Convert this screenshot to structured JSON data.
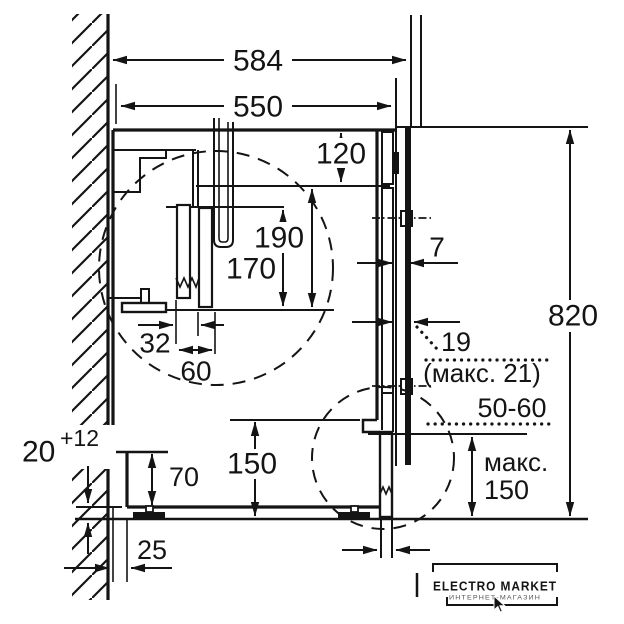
{
  "drawing": {
    "title": "built-in-washing-machine-installation-diagram",
    "colors": {
      "line": "#141414",
      "background": "#ffffff"
    },
    "dimensions": {
      "depth_total": "584",
      "depth_niche": "550",
      "top_clearance": "120",
      "hose_height_long": "190",
      "hose_height_short": "170",
      "hose_offset_small": "32",
      "hose_offset_large": "60",
      "door_gap": "7",
      "niche_height": "820",
      "door_thickness": "19",
      "door_thickness_max": "(макс. 21)",
      "plinth_recess": "50-60",
      "plinth_max_word": "макс.",
      "plinth_max_value": "150",
      "bottom_clearance": "150",
      "rear_step_height": "70",
      "feet_adjust_value": "20",
      "feet_adjust_tolerance": "+12",
      "rear_step_depth": "25"
    },
    "watermark": {
      "title": "ELECTRO MARKET",
      "subtitle": "ИНТЕРНЕТ-МАГАЗИН",
      "icon": "cursor-arrow-icon"
    }
  }
}
